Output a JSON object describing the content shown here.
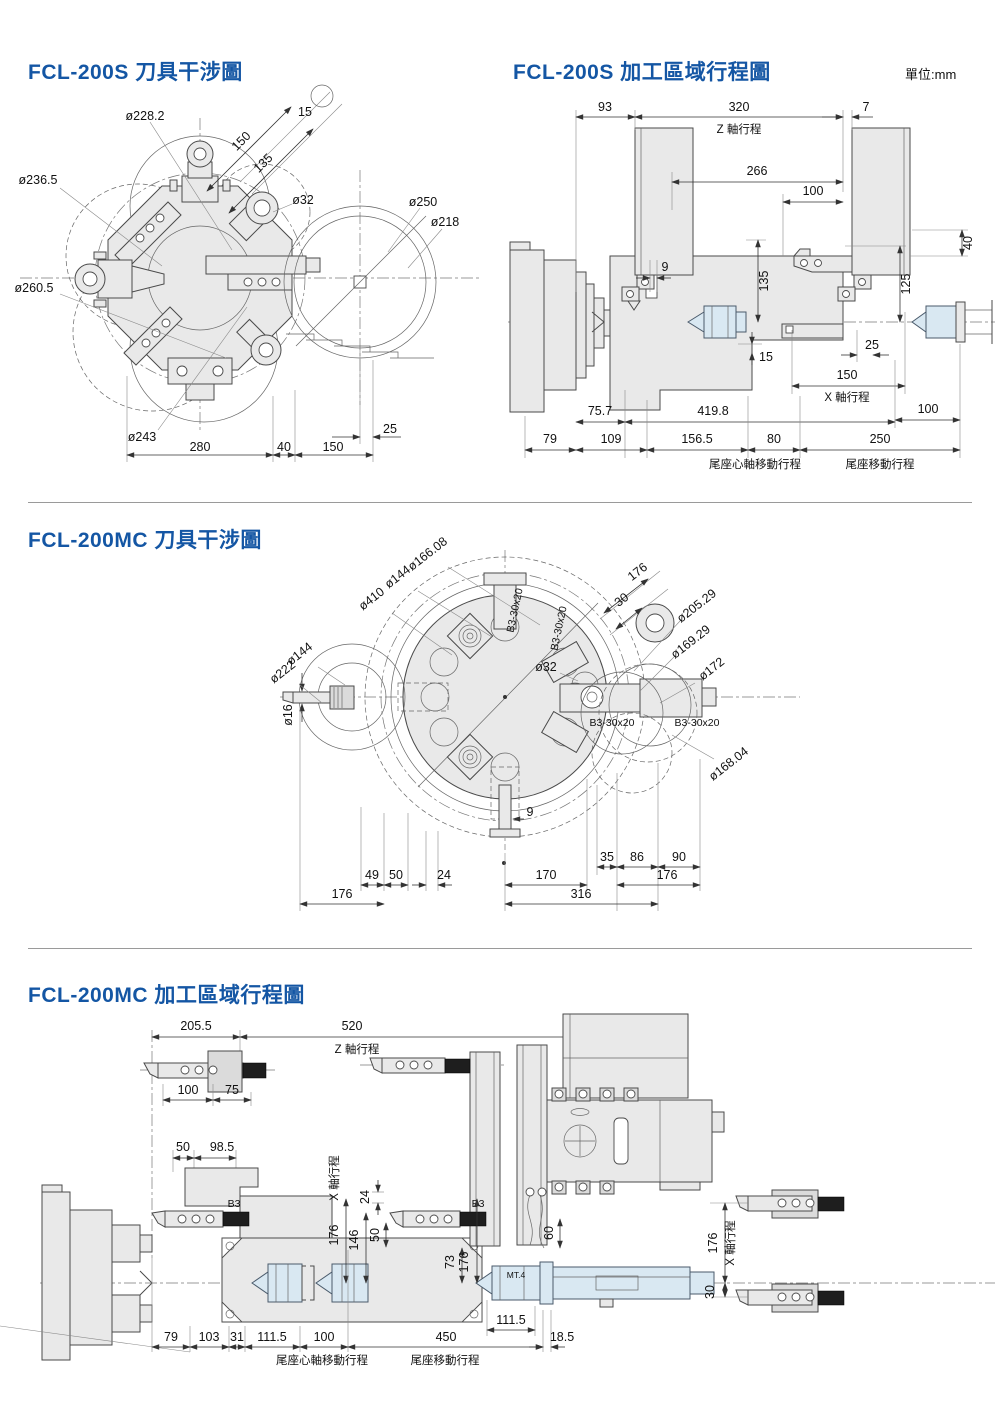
{
  "page": {
    "unit": "單位:mm"
  },
  "colors": {
    "title_blue": "#1456A4",
    "part_fill": "#E9E9E9",
    "accent_fill": "#D9E8F2"
  },
  "s1": {
    "model": "FCL-200S",
    "title": "刀具干涉圖",
    "d": {
      "c228": "ø228.2",
      "n15": "15",
      "n150": "150",
      "n135": "135",
      "c236": "ø236.5",
      "c32": "ø32",
      "c250": "ø250",
      "c218": "ø218",
      "c260": "ø260.5",
      "c243": "ø243",
      "n280": "280",
      "n40": "40",
      "n150b": "150",
      "n25": "25"
    }
  },
  "s2": {
    "model": "FCL-200S",
    "title": "加工區域行程圖",
    "d": {
      "n93": "93",
      "n320": "320",
      "n7": "7",
      "zaxis": "Z 軸行程",
      "n266": "266",
      "n100": "100",
      "n40": "40",
      "n125": "125",
      "n135": "135",
      "n9": "9",
      "n15": "15",
      "n25": "25",
      "n150": "150",
      "xaxis": "X 軸行程",
      "n100b": "100",
      "n757": "75.7",
      "n4198": "419.8",
      "n79": "79",
      "n109": "109",
      "n1565": "156.5",
      "n80": "80",
      "n250": "250",
      "tailA": "尾座心軸移動行程",
      "tailB": "尾座移動行程"
    }
  },
  "s3": {
    "model": "FCL-200MC",
    "title": "刀具干涉圖",
    "d": {
      "c166": "ø166.08",
      "c144a": "ø144",
      "c410": "ø410",
      "c144b": "ø144",
      "c222": "ø222",
      "c16": "ø16",
      "n176t": "176",
      "n30": "30",
      "c205": "ø205.29",
      "c169": "ø169.29",
      "c172": "ø172",
      "c32": "ø32",
      "b3a": "B3-30x20",
      "b3b": "B3-30x20",
      "b3c": "B3-30x20",
      "b3d": "B3-30x20",
      "c168": "ø168.04",
      "n9": "9",
      "n35": "35",
      "n86": "86",
      "n90": "90",
      "n176r": "176",
      "n49": "49",
      "n50": "50",
      "n24": "24",
      "n170": "170",
      "n176l": "176",
      "n316": "316"
    }
  },
  "s4": {
    "model": "FCL-200MC",
    "title": "加工區域行程圖",
    "d": {
      "n2055": "205.5",
      "n520": "520",
      "zaxis": "Z 軸行程",
      "n100": "100",
      "n75": "75",
      "n50": "50",
      "n985": "98.5",
      "b3a": "B3",
      "b3b": "B3",
      "xaxisL": "X 軸行程",
      "n24": "24",
      "n176a": "176",
      "n146": "146",
      "n50b": "50",
      "n60": "60",
      "n73": "73",
      "n176b": "176",
      "mt4": "MT.4",
      "n176c": "176",
      "xaxisR": "X 軸行程",
      "n30": "30",
      "n79": "79",
      "n103": "103",
      "n31": "31",
      "n1115a": "111.5",
      "n100b": "100",
      "n450": "450",
      "n1115b": "111.5",
      "n185": "18.5",
      "tailA": "尾座心軸移動行程",
      "tailB": "尾座移動行程"
    }
  }
}
